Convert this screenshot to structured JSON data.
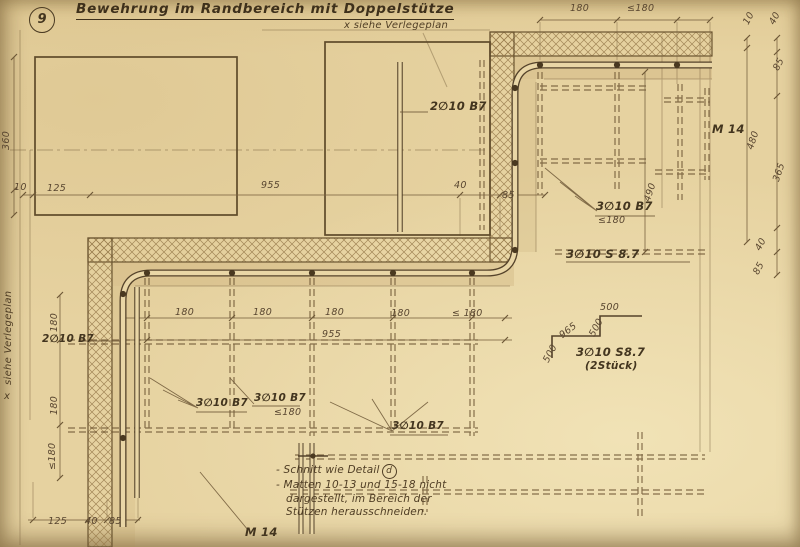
{
  "page": {
    "number_badge": "9",
    "title": "Bewehrung im Randbereich mit Doppelstütze",
    "top_note": "x siehe Verlegeplan",
    "side_note_marker": "x",
    "side_note": "siehe Verlegeplan"
  },
  "colors": {
    "paper": "#e6d2a0",
    "ink": "#5a4629",
    "hatch": "#97794a"
  },
  "dims": {
    "top_180": "180",
    "top_le180": "≤180",
    "r_10": "10",
    "r_40a": "40",
    "r_85a": "85",
    "r_480": "480",
    "r_365": "365",
    "r_40b": "40",
    "r_85b": "85",
    "r_490": "490",
    "row1_10": "10",
    "row1_125": "125",
    "row1_955": "955",
    "row1_40": "40",
    "row1_85": "85",
    "left_360": "360",
    "mid_180a": "180",
    "mid_180b": "180",
    "mid_180c": "180",
    "mid_180d": "180",
    "mid_le180": "≤ 180",
    "mid_955": "955",
    "lcol_180a": "180",
    "lcol_180b": "180",
    "lcol_le180": "≤180",
    "bot_125": "125",
    "bot_40": "40",
    "bot_85": "85",
    "step_500a": "500",
    "step_500b": "500",
    "step_965": "965",
    "step_500c": "500"
  },
  "bars": {
    "top": "2∅10 B7",
    "left": "2∅10 B7",
    "right_b7": "3∅10 B7",
    "right_b7_sp": "≤180",
    "right_s87": "3∅10 S 8.7",
    "l1": "3∅10 B7",
    "l2": "3∅10 B7",
    "l2_sp": "≤180",
    "mid": "3∅10 B7",
    "step_name": "3∅10 S8.7",
    "step_count": "(2Stück)",
    "m14_right": "M 14",
    "m14_bottom": "M 14"
  },
  "notes": {
    "line1": "- Schnitt wie Detail",
    "line1_ref": "d",
    "line2": "- Matten 10-13 und 15-18 nicht",
    "line3": "dargestellt, im Bereich der",
    "line4": "Stützen herausschneiden."
  }
}
